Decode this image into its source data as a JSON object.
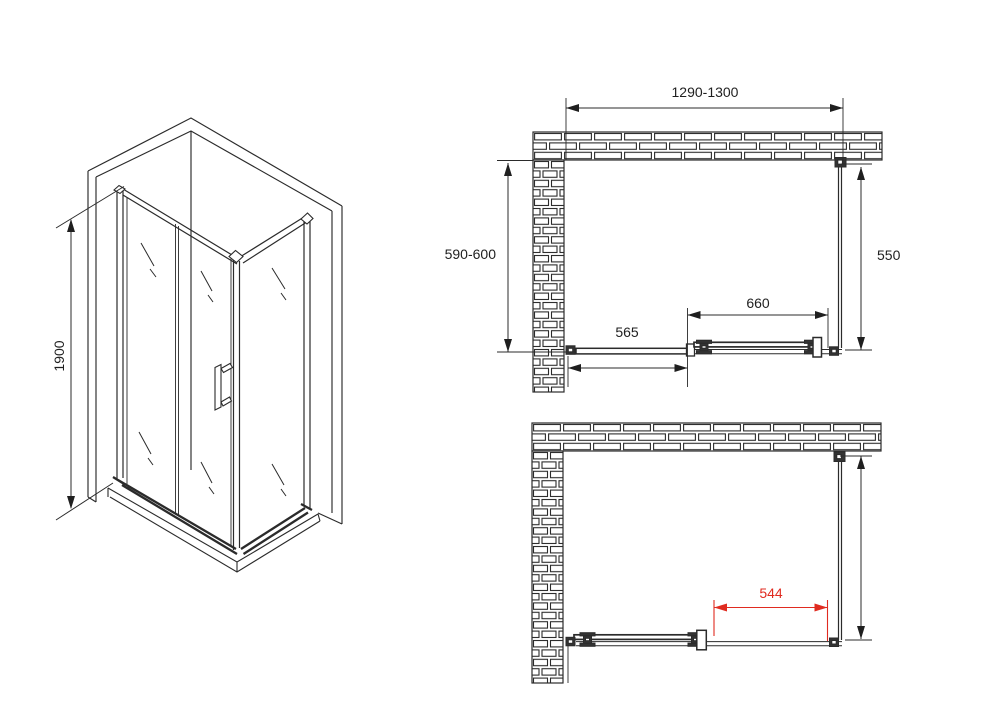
{
  "diagram": {
    "title": "Shower enclosure installation drawing",
    "colors": {
      "line": "#2b2b2b",
      "accent_red": "#e02b20",
      "background": "#ffffff"
    },
    "iso_view": {
      "dims": {
        "height": "1900"
      }
    },
    "plan_top": {
      "dims": {
        "width": "1290-1300",
        "depth": "590-600",
        "side_panel": "550",
        "door_panel": "660",
        "fixed_panel": "565"
      }
    },
    "plan_bottom": {
      "dims": {
        "opening": "544"
      }
    }
  }
}
